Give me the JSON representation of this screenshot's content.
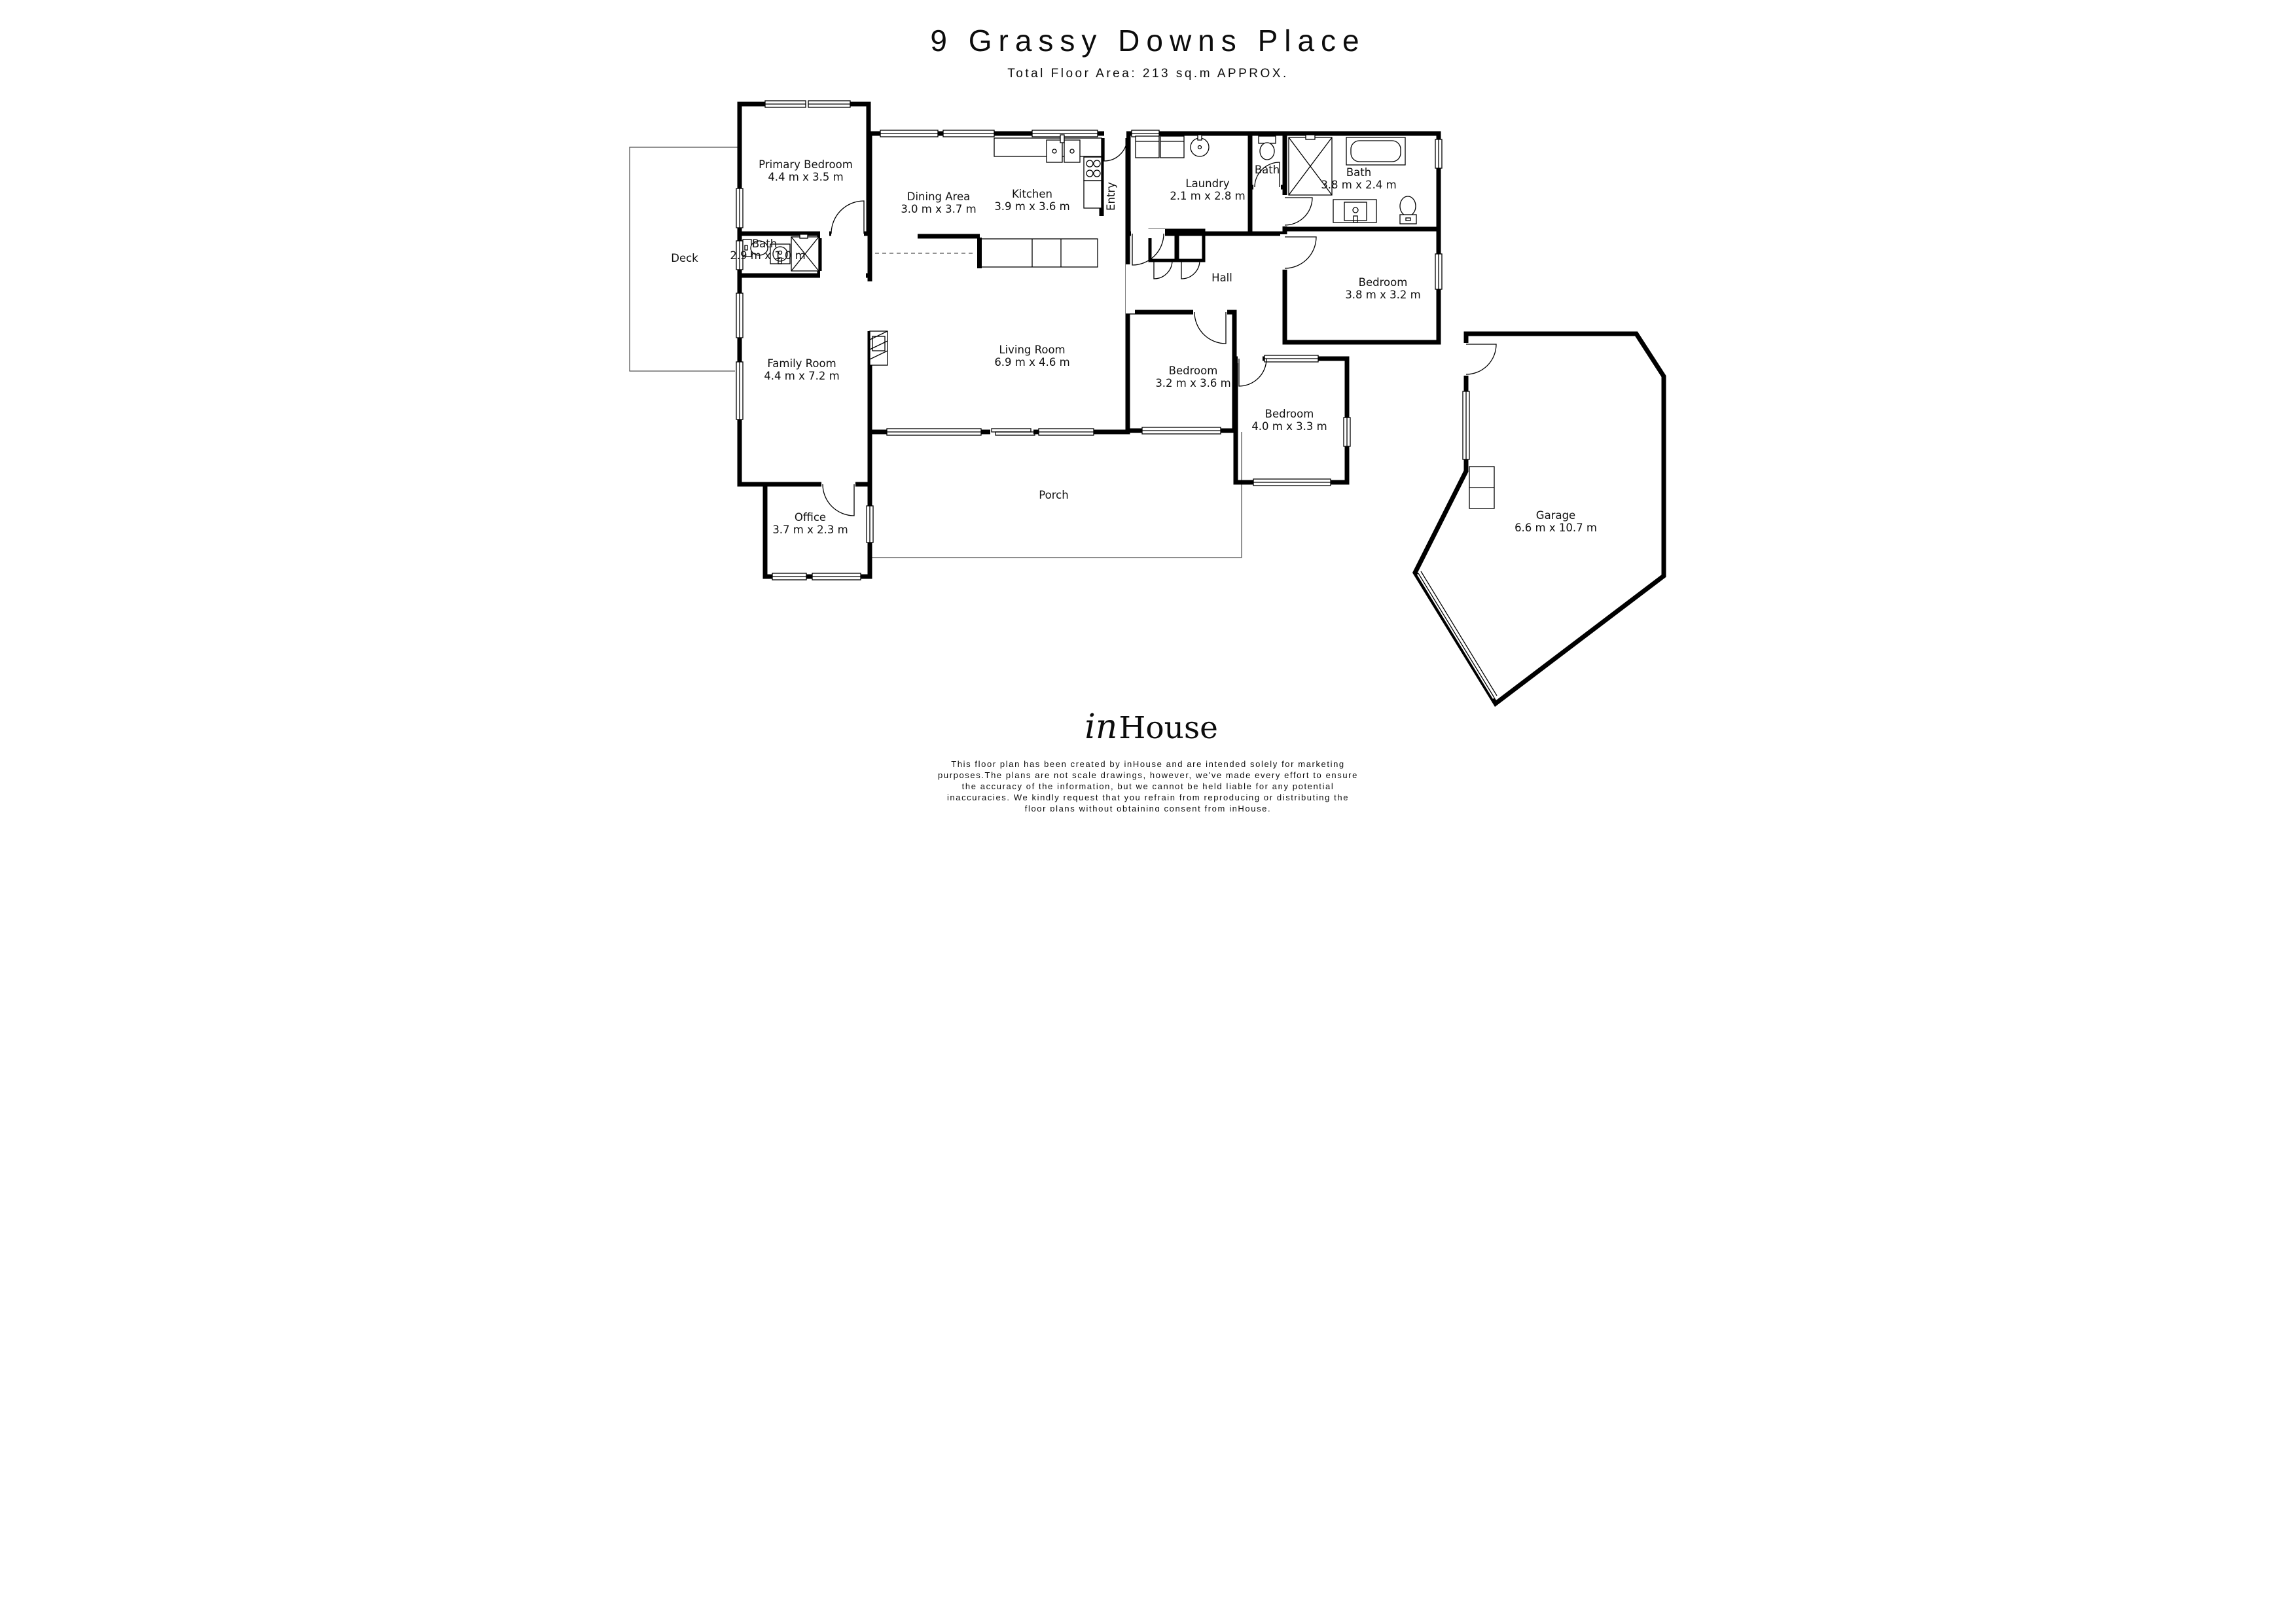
{
  "header": {
    "title": "9 Grassy Downs Place",
    "subtitle": "Total Floor Area: 213 sq.m APPROX."
  },
  "rooms": {
    "deck": {
      "label": "Deck"
    },
    "primary_bedroom": {
      "label": "Primary Bedroom",
      "dims": "4.4 m x 3.5 m"
    },
    "ensuite_bath": {
      "label": "Bath",
      "dims": "2.9 m x 1.0 m"
    },
    "family_room": {
      "label": "Family Room",
      "dims": "4.4 m x 7.2 m"
    },
    "office": {
      "label": "Office",
      "dims": "3.7 m x 2.3 m"
    },
    "dining_area": {
      "label": "Dining Area",
      "dims": "3.0 m x 3.7 m"
    },
    "kitchen": {
      "label": "Kitchen",
      "dims": "3.9 m x 3.6 m"
    },
    "entry": {
      "label": "Entry"
    },
    "laundry": {
      "label": "Laundry",
      "dims": "2.1 m x 2.8 m"
    },
    "bath_small": {
      "label": "Bath"
    },
    "bath_main": {
      "label": "Bath",
      "dims": "3.8 m x 2.4 m"
    },
    "hall": {
      "label": "Hall"
    },
    "living_room": {
      "label": "Living Room",
      "dims": "6.9 m x 4.6 m"
    },
    "bedroom_rear": {
      "label": "Bedroom",
      "dims": "3.8 m x 3.2 m"
    },
    "bedroom_mid": {
      "label": "Bedroom",
      "dims": "3.2 m x 3.6 m"
    },
    "bedroom_right": {
      "label": "Bedroom",
      "dims": "4.0 m x 3.3 m"
    },
    "porch": {
      "label": "Porch"
    },
    "garage": {
      "label": "Garage",
      "dims": "6.6 m x 10.7 m"
    }
  },
  "fixtures": [
    "toilet-icon",
    "sink-icon",
    "shower-icon",
    "bathtub-icon",
    "vanity-icon",
    "stove-icon",
    "kitchen-sink-icon",
    "washer-icon",
    "dryer-icon",
    "fireplace-icon",
    "garage-cabinet-icon",
    "door-arc",
    "window-glyph"
  ],
  "footer": {
    "logo_in": "in",
    "logo_house": "House",
    "disclaimer_lines": [
      "This floor plan has been created by inHouse and are intended solely for marketing",
      "purposes.The plans are not scale drawings, however, we've made every effort to ensure",
      "the accuracy of the information, but we cannot be held liable for any potential",
      "inaccuracies. We kindly request that you refrain from reproducing or distributing the",
      "floor plans without obtaining consent from inHouse."
    ]
  },
  "colors": {
    "wall": "#000000",
    "background": "#ffffff",
    "text": "#0c0c0c"
  }
}
